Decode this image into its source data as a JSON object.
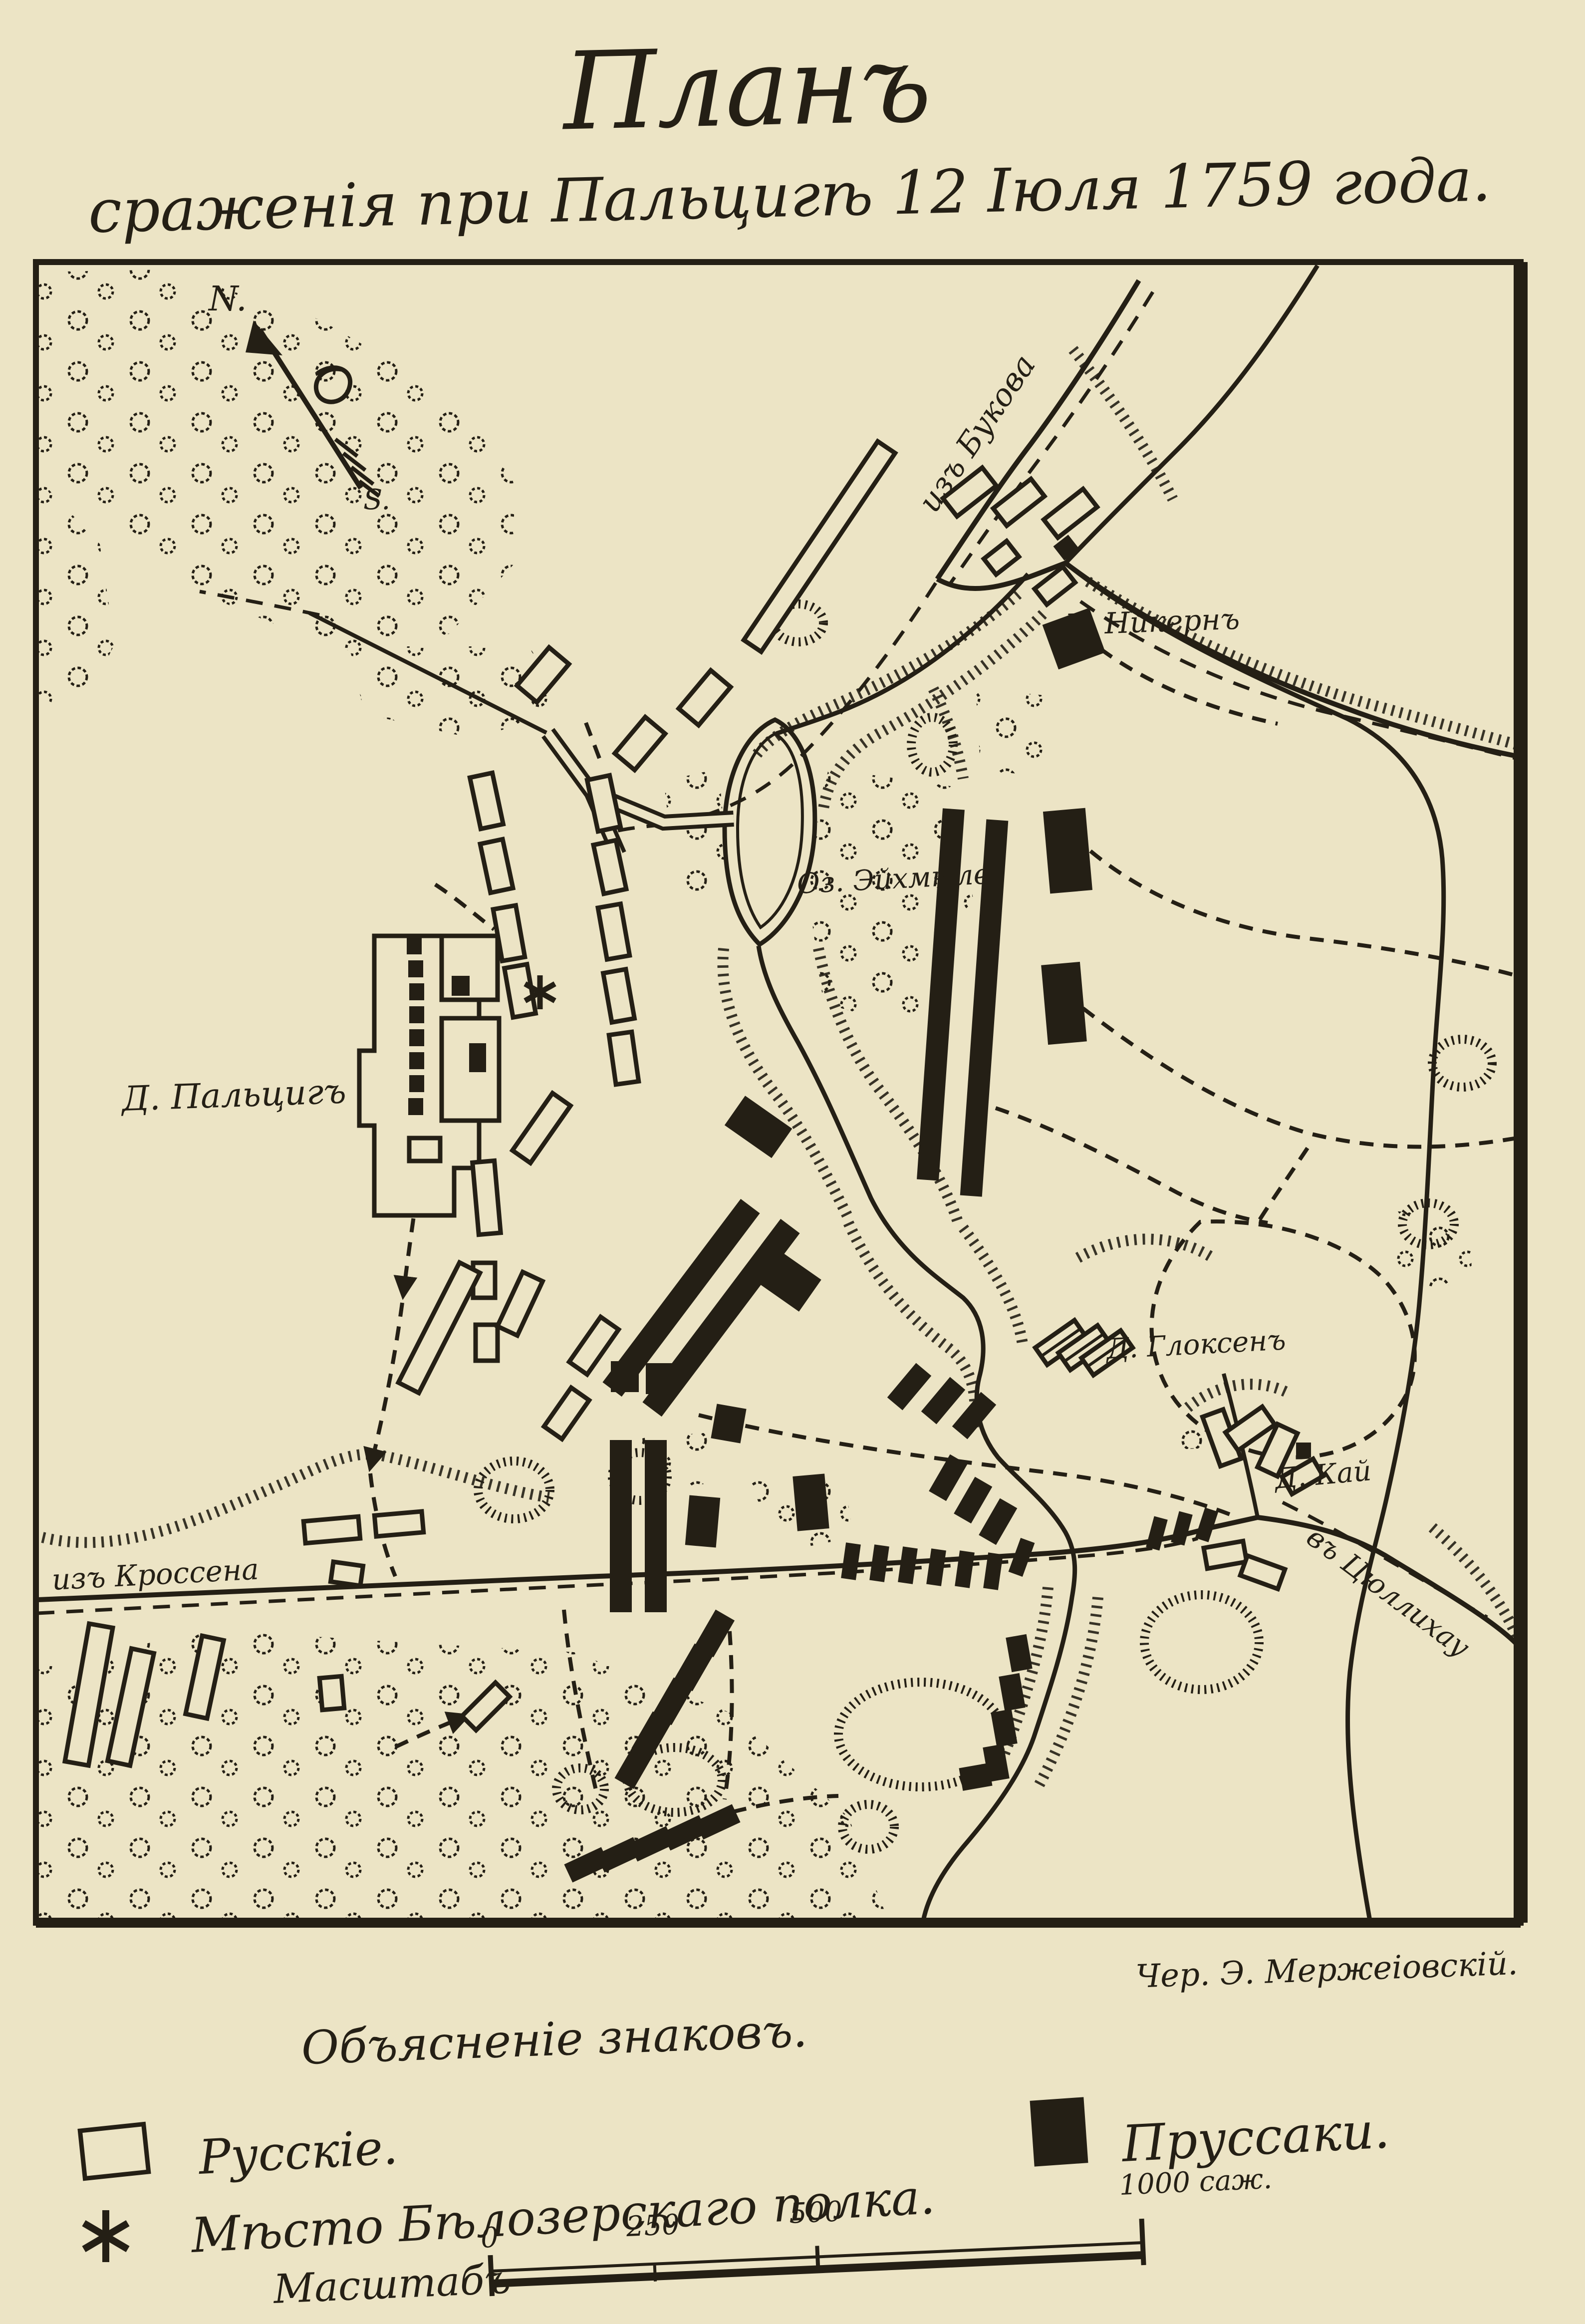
{
  "colors": {
    "paper": "#ece4c5",
    "ink": "#241f15"
  },
  "title": {
    "line1": "Планъ",
    "line2": "сраженія при Пальцигѣ 12 Іюля 1759 года."
  },
  "compass": {
    "n": "N.",
    "s": "S."
  },
  "map": {
    "labels": {
      "bukow": "изъ Букова",
      "krossen": "изъ Кроссена",
      "zullichau": "въ Цюллихау",
      "nickern": "Д. Никернъ",
      "palzig": "Д. Пальцигъ",
      "gloksen": "Д. Глоксенъ",
      "kay": "Д. Кай",
      "lake": "Оз. Эйхмюле"
    }
  },
  "credit": "Чер. Э. Мержеіовскій.",
  "legend": {
    "heading": "Объясненіе знаковъ.",
    "russians": "Русскіе.",
    "prussians": "Пруссаки.",
    "belozersky": "Мѣсто Бѣлозерскаго полка."
  },
  "scale": {
    "label": "Масштабъ",
    "t0": "0",
    "t250": "250",
    "t500": "500",
    "t1000": "1000 саж."
  }
}
